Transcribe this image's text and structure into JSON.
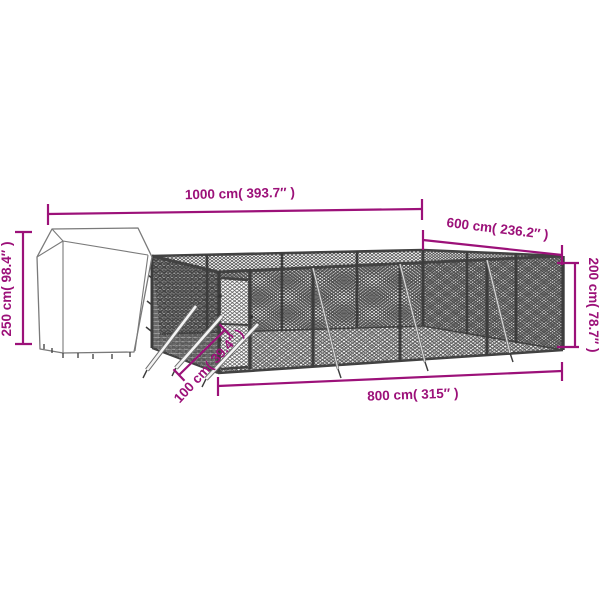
{
  "page": {
    "background_color": "#ffffff",
    "subject": "outdoor chain-link dog kennel with fabric roof shelter, dimension diagram"
  },
  "colors": {
    "dimension_accent": "#9C1179",
    "frame_metal": "#3c3c3c",
    "mesh_dark": "#4a4a4a",
    "mesh_shadow": "#b2b2b2",
    "tent_outline": "#7a7a7a"
  },
  "dimensions": {
    "total_length": {
      "label": "1000 cm( 393.7″ )",
      "value_cm": 1000,
      "value_in": 393.7
    },
    "side_depth": {
      "label": "600 cm( 236.2″ )",
      "value_cm": 600,
      "value_in": 236.2
    },
    "shelter_height": {
      "label": "250 cm( 98.4″ )",
      "value_cm": 250,
      "value_in": 98.4
    },
    "fence_height": {
      "label": "200 cm( 78.7″ )",
      "value_cm": 200,
      "value_in": 78.7
    },
    "front_length": {
      "label": "800 cm( 315″ )",
      "value_cm": 800,
      "value_in": 315
    },
    "door_section": {
      "label": "100 cm( 39.4″ )",
      "value_cm": 100,
      "value_in": 39.4
    }
  }
}
